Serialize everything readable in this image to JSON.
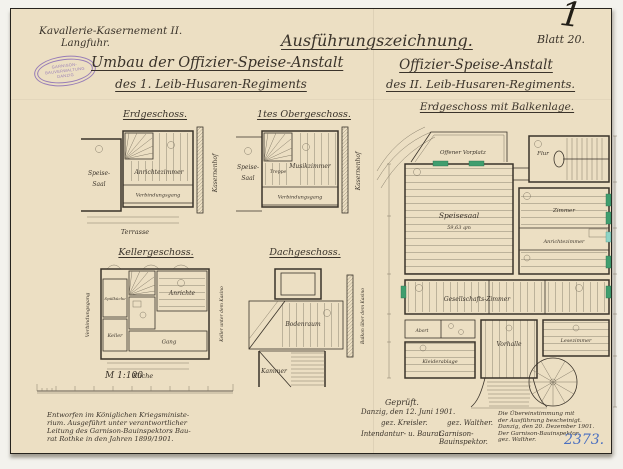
{
  "colors": {
    "paper": "#ecdfc3",
    "ink": "#3a332a",
    "stamp_purple": "#8a6db5",
    "archive_blue": "#4a6fc0",
    "highlight_green": "#3f9e6e"
  },
  "header": {
    "left_line1": "Kavallerie-Kasernement II.",
    "left_line2": "Langfuhr.",
    "center_title": "Ausführungszeichnung.",
    "sheet_label": "Blatt 20.",
    "corner_mark": "1",
    "stamp_lines": [
      "GARNISON-",
      "BAUVERWALTUNG",
      "DANZIG"
    ],
    "left_subject_line1": "Umbau der Offizier-Speise-Anstalt",
    "left_subject_line2": "des 1. Leib-Husaren-Regiments",
    "right_subject_line1": "Offizier-Speise-Anstalt",
    "right_subject_line2": "des II. Leib-Husaren-Regiments."
  },
  "plans": {
    "erdgeschoss": {
      "title": "Erdgeschoss.",
      "speise1": "Speise-",
      "speise2": "Saal",
      "anrichte": "Anrichtezimmer",
      "gang": "Verbindungsgang",
      "street": "Kasernenhof",
      "terrasse": "Terrasse"
    },
    "obergeschoss": {
      "title": "1tes Obergeschoss.",
      "speise1": "Speise-",
      "speise2": "Saal",
      "musik": "Musikzimmer",
      "gang": "Verbindungsgang",
      "treppe": "Treppe",
      "street": "Kasernenhof"
    },
    "keller": {
      "title": "Kellergeschoss.",
      "spuelkueche": "Spülküche",
      "keller": "Keller",
      "anrichte": "Anrichte",
      "gang": "Gang",
      "kueche": "Küche",
      "verbindungsgang": "Verbindungsgang",
      "side": "Keller unter dem Kasino"
    },
    "dach": {
      "title": "Dachgeschoss.",
      "bodenraum": "Bodenraum",
      "kammer": "Kammer",
      "side": "Balkon über dem Kasino"
    },
    "haupt": {
      "title": "Erdgeschoss mit Balkenlage.",
      "vorplatz": "Offener Vorplatz",
      "speisesaal": "Speisesaal",
      "area": "59,63 qm",
      "flur": "Flur",
      "zimmer": "Zimmer",
      "anrichte": "Anrichtezimmer",
      "gesellschaft": "Gesellschafts-Zimmer",
      "vorhalle": "Vorhalle",
      "kleiderablage": "Kleiderablage",
      "lesezimmer": "Lesezimmer",
      "abort": "Abort"
    }
  },
  "scale": {
    "label": "M 1:100"
  },
  "footer": {
    "provenance": [
      "Entworfen im Königlichen Kriegsministe-",
      "rium. Ausgeführt unter verantwortlicher",
      "Leitung des Garnison-Bauinspektors Bau-",
      "rat Rothke in den Jahren 1899/1901."
    ],
    "approval": {
      "heading": "Geprüft.",
      "place_date": "Danzig, den 12. Juni 1901.",
      "signature_left": "gez. Kreisler.",
      "signature_right": "gez. Walther.",
      "role_left": "Intendantur- u. Baurat.",
      "role_right": "Garnison-Bauinspektor."
    },
    "certification": [
      "Die Übereinstimmung mit",
      "der Ausführung bescheinigt.",
      "Danzig, den 20. Dezember 1901.",
      "Der Garnison-Bauinspektor.",
      "gez. Walther."
    ],
    "archive_number": "2373."
  }
}
